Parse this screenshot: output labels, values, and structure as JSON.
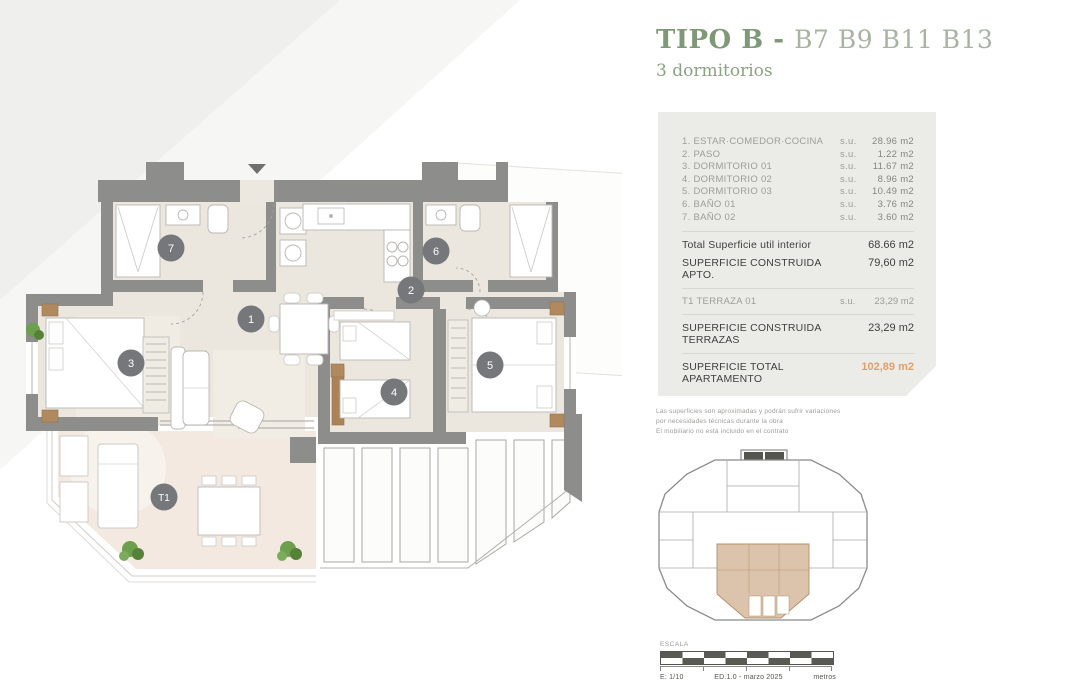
{
  "header": {
    "title": "TIPO B",
    "separator": " - ",
    "units": "B7 B9 B11 B13",
    "subtitle": "3 dormitorios"
  },
  "surface_table": {
    "rooms": [
      {
        "name": "1. ESTAR·COMEDOR·COCINA",
        "su": "s.u.",
        "value": "28.96 m2"
      },
      {
        "name": "2. PASO",
        "su": "s.u.",
        "value": "1.22 m2"
      },
      {
        "name": "3. DORMITORIO 01",
        "su": "s.u.",
        "value": "11.67 m2"
      },
      {
        "name": "4. DORMITORIO 02",
        "su": "s.u.",
        "value": "8.96 m2"
      },
      {
        "name": "5. DORMITORIO 03",
        "su": "s.u.",
        "value": "10.49 m2"
      },
      {
        "name": "6. BAÑO 01",
        "su": "s.u.",
        "value": "3.76 m2"
      },
      {
        "name": "7. BAÑO 02",
        "su": "s.u.",
        "value": "3.60 m2"
      }
    ],
    "total_util": {
      "label": "Total Superficie util interior",
      "value": "68.66 m2"
    },
    "construida_apto": {
      "label": "SUPERFICIE CONSTRUIDA APTO.",
      "value": "79,60 m2"
    },
    "terraza": {
      "label": "T1 TERRAZA 01",
      "su": "s.u.",
      "value": "23,29 m2"
    },
    "construida_terrazas": {
      "label": "SUPERFICIE CONSTRUIDA TERRAZAS",
      "value": "23,29 m2"
    },
    "total_apartamento": {
      "label": "SUPERFICIE TOTAL APARTAMENTO",
      "value": "102,89 m2"
    }
  },
  "disclaimer": {
    "line1": "Las superficies son aproximadas y podrán sufrir variaciones",
    "line2": "por necesidades técnicas durante la obra",
    "line3": "El mobiliario no está incluido en el contrato"
  },
  "scale_bar": {
    "label": "ESCALA",
    "ratio": "E: 1/10",
    "edition": "ED.1.0 - marzo 2025",
    "unit": "metros"
  },
  "plan": {
    "labels": {
      "r1": "1",
      "r2": "2",
      "r3": "3",
      "r4": "4",
      "r5": "5",
      "r6": "6",
      "r7": "7",
      "t1": "T1"
    }
  },
  "colors": {
    "accent_green": "#7e9878",
    "light_green": "#a9b3a2",
    "total_orange": "#df9f6a",
    "wall_gray": "#8d8e8c",
    "circle_gray": "#75777a",
    "interior_floor": "#ebe7df",
    "terrace_floor": "#f4e9e1",
    "panel_bg": "#ebece8",
    "keyplan_highlight": "#dcc3ab"
  }
}
